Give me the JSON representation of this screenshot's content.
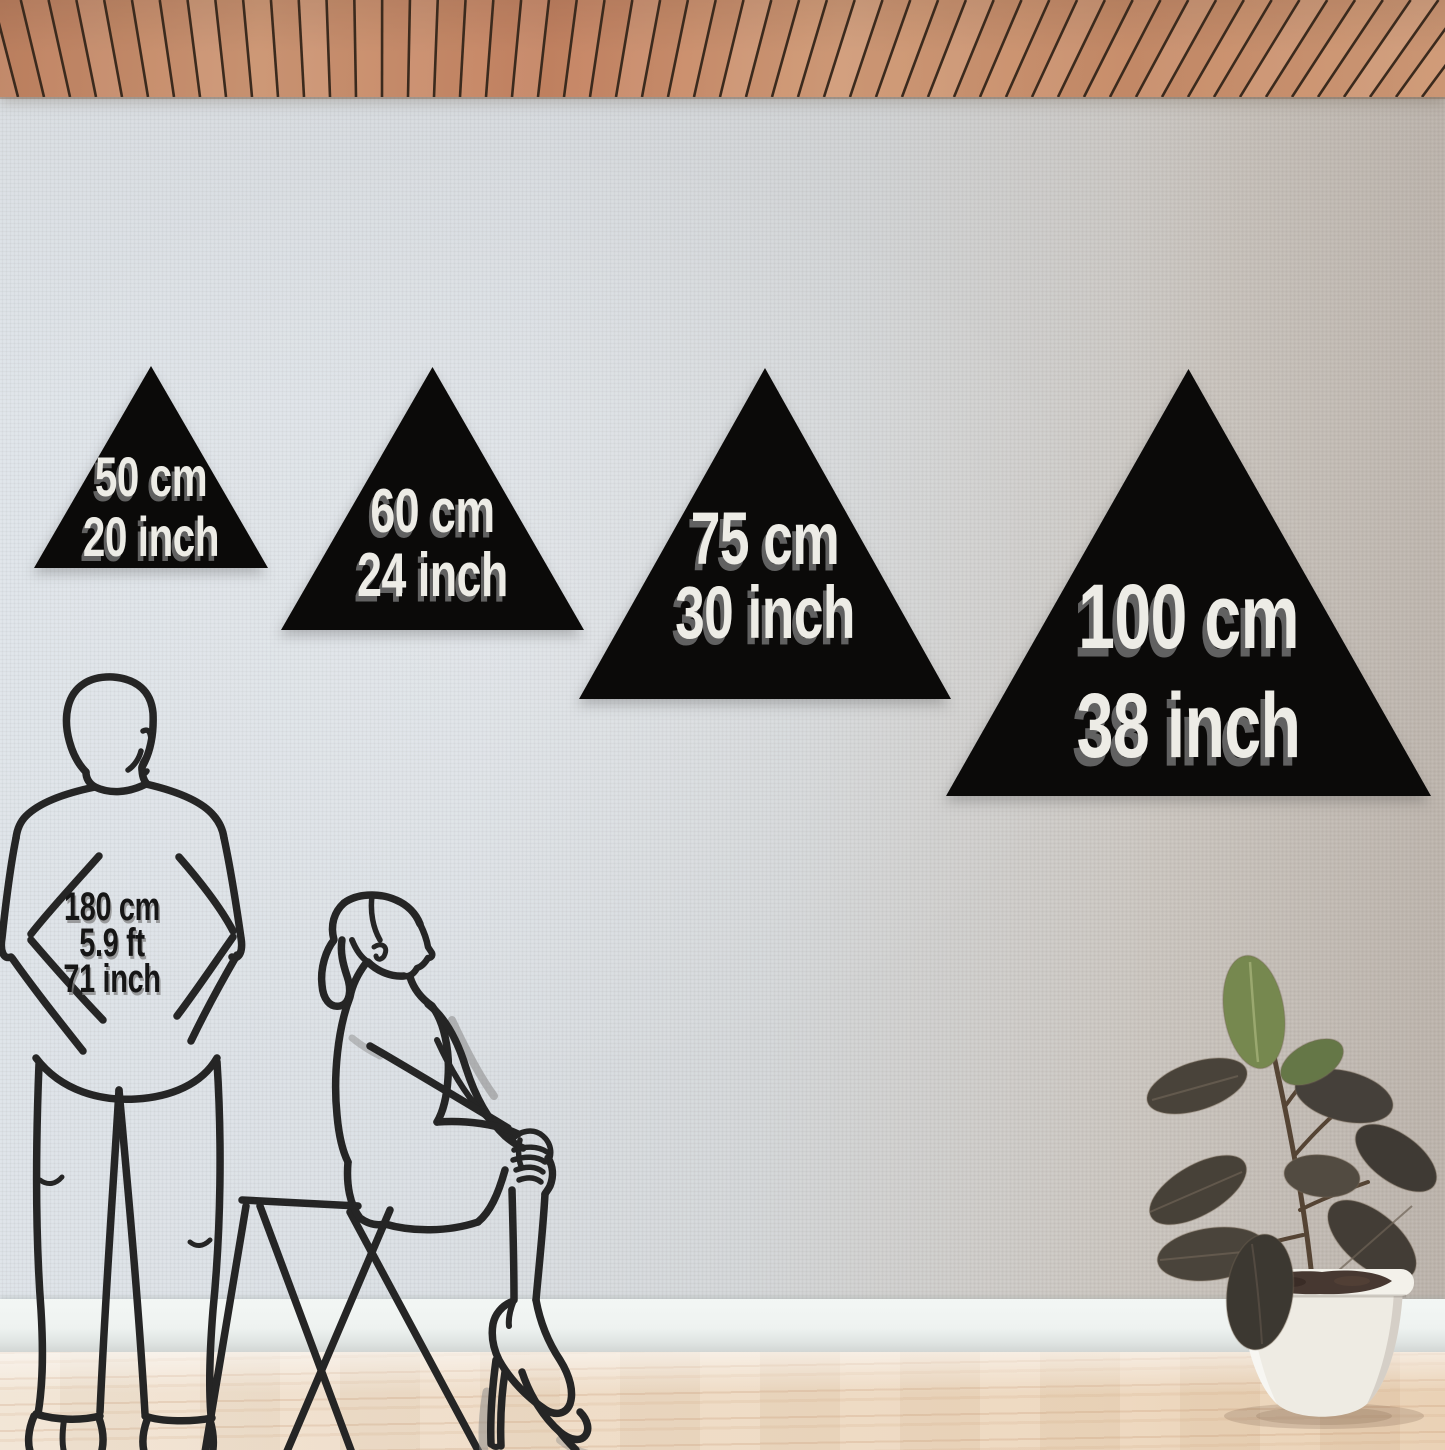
{
  "triangles": [
    {
      "cm": "50 cm",
      "inch": "20 inch"
    },
    {
      "cm": "60 cm",
      "inch": "24 inch"
    },
    {
      "cm": "75 cm",
      "inch": "30 inch"
    },
    {
      "cm": "100 cm",
      "inch": "38 inch"
    }
  ],
  "person_reference": {
    "cm": "180 cm",
    "ft": "5.9 ft",
    "inch": "71 inch"
  },
  "colors": {
    "triangle_fill": "#0b0a09",
    "triangle_label": "#edece6",
    "triangle_label_shadow": "#696969",
    "person_label": "#161616",
    "line_art": "#252525",
    "wall_left": "#dee4e9",
    "wall_right": "#c2bbb3",
    "ceiling_wood": "#c98f6c",
    "ceiling_gap": "#3b2a1d",
    "baseboard": "#f0f4f2",
    "floor_wood": "#eddcc6",
    "pot": "#f1eee7",
    "soil": "#473831",
    "leaf_green": "#76884f",
    "leaf_dark": "#45403a"
  }
}
